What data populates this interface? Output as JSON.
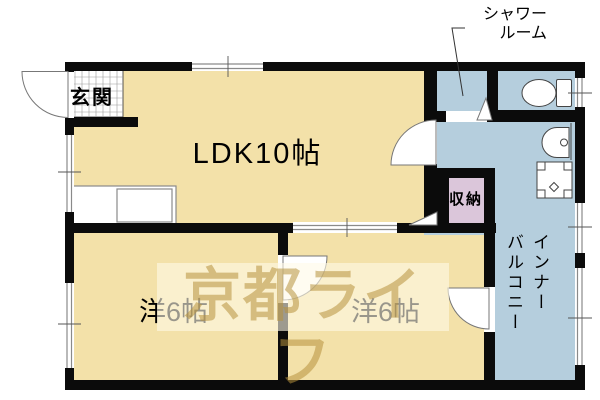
{
  "labels": {
    "entrance": "玄関",
    "ldk": "LDK10帖",
    "shower_room": "シャワー\nルーム",
    "storage": "収納",
    "bedroom_left": "洋6帖",
    "bedroom_right": "洋6帖",
    "inner_balcony": "インナー\nバルコニー",
    "watermark": "京都ライフ"
  },
  "colors": {
    "room_fill": "#f3e1a9",
    "wet_area_fill": "#b5cedd",
    "storage_fill": "#dbc6da",
    "wall": "#0b0b0b",
    "watermark_bg": "rgba(255,250,232,0.6)",
    "watermark_text": "rgba(183,146,61,0.55)"
  }
}
